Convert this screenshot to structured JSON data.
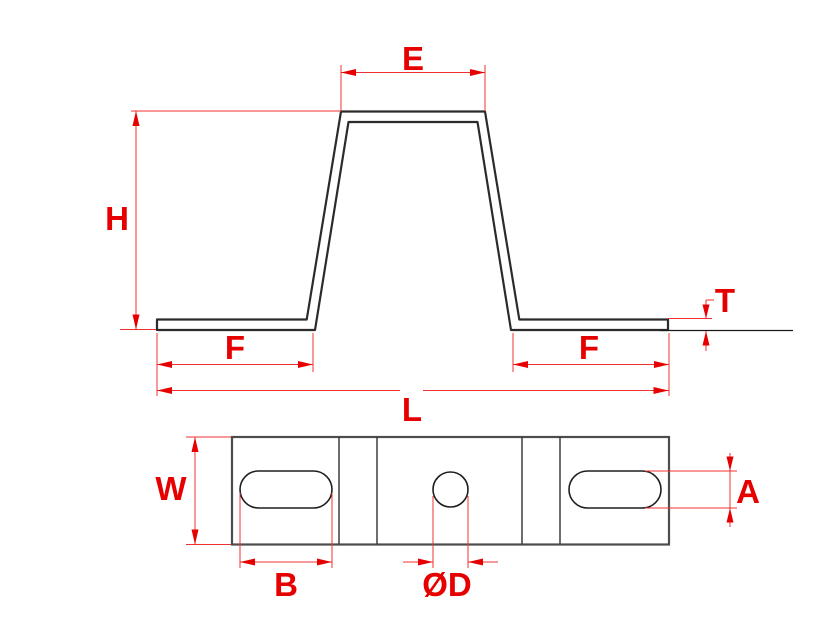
{
  "drawing": {
    "colors": {
      "dimension_red": "#e60000",
      "outline_black": "#2b2b2b",
      "background": "#ffffff"
    },
    "labels": {
      "e": "E",
      "h": "H",
      "t": "T",
      "f_left": "F",
      "f_right": "F",
      "l": "L",
      "w": "W",
      "a": "A",
      "b": "B",
      "d": "ØD"
    }
  }
}
